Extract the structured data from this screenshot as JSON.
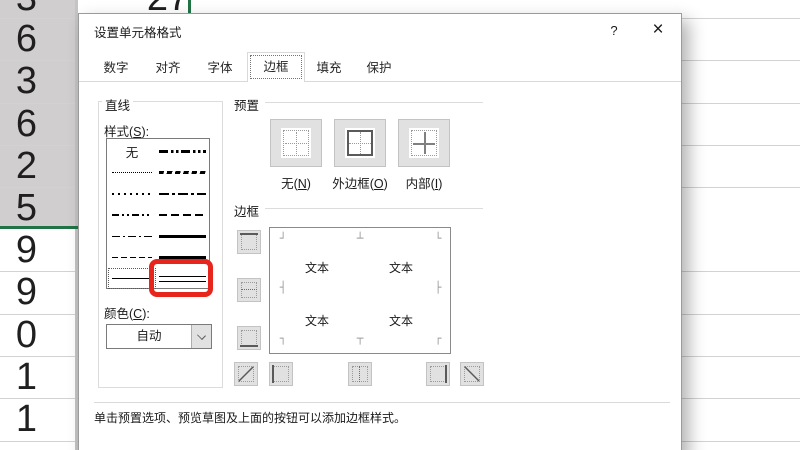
{
  "background": {
    "top_cell_value": "27",
    "column_values": [
      "3",
      "6",
      "3",
      "6",
      "2",
      "5",
      "9",
      "9",
      "0",
      "1",
      "1"
    ],
    "selection_color": "#217346"
  },
  "dialog": {
    "title": "设置单元格格式",
    "help_button": "?",
    "close_button": "×",
    "tabs": [
      {
        "label": "数字"
      },
      {
        "label": "对齐"
      },
      {
        "label": "字体"
      },
      {
        "label": "边框"
      },
      {
        "label": "填充"
      },
      {
        "label": "保护"
      }
    ],
    "selected_tab": "边框",
    "line_group": {
      "title": "直线",
      "style_label_pre": "样式(",
      "style_label_key": "S",
      "style_label_post": "):",
      "none_item_label": "无",
      "styles_left": [
        "none",
        "hairline-dotted",
        "dotted",
        "dash-dot-dot",
        "dash-dot",
        "dashed",
        "thin-solid"
      ],
      "styles_right": [
        "medium-dash-dot-dot",
        "slant-dash-dot",
        "medium-dash-dot",
        "medium-dashed",
        "medium-solid",
        "thick-solid",
        "double"
      ],
      "selected_style": "thin-solid",
      "color_label_pre": "颜色(",
      "color_label_key": "C",
      "color_label_post": "):",
      "color_value": "自动"
    },
    "presets_group": {
      "title": "预置",
      "buttons": [
        {
          "label_pre": "无(",
          "label_key": "N",
          "label_post": ")"
        },
        {
          "label_pre": "外边框(",
          "label_key": "O",
          "label_post": ")"
        },
        {
          "label_pre": "内部(",
          "label_key": "I",
          "label_post": ")"
        }
      ]
    },
    "border_group": {
      "title": "边框",
      "preview_text": "文本",
      "corner_marks": [
        "┘",
        "┴",
        "└",
        "┤",
        "├",
        "┐",
        "┬",
        "┌"
      ]
    },
    "footer_hint": "单击预置选项、预览草图及上面的按钮可以添加边框样式。",
    "annotation": {
      "highlighted_style": "double",
      "color": "#e8251d"
    }
  }
}
